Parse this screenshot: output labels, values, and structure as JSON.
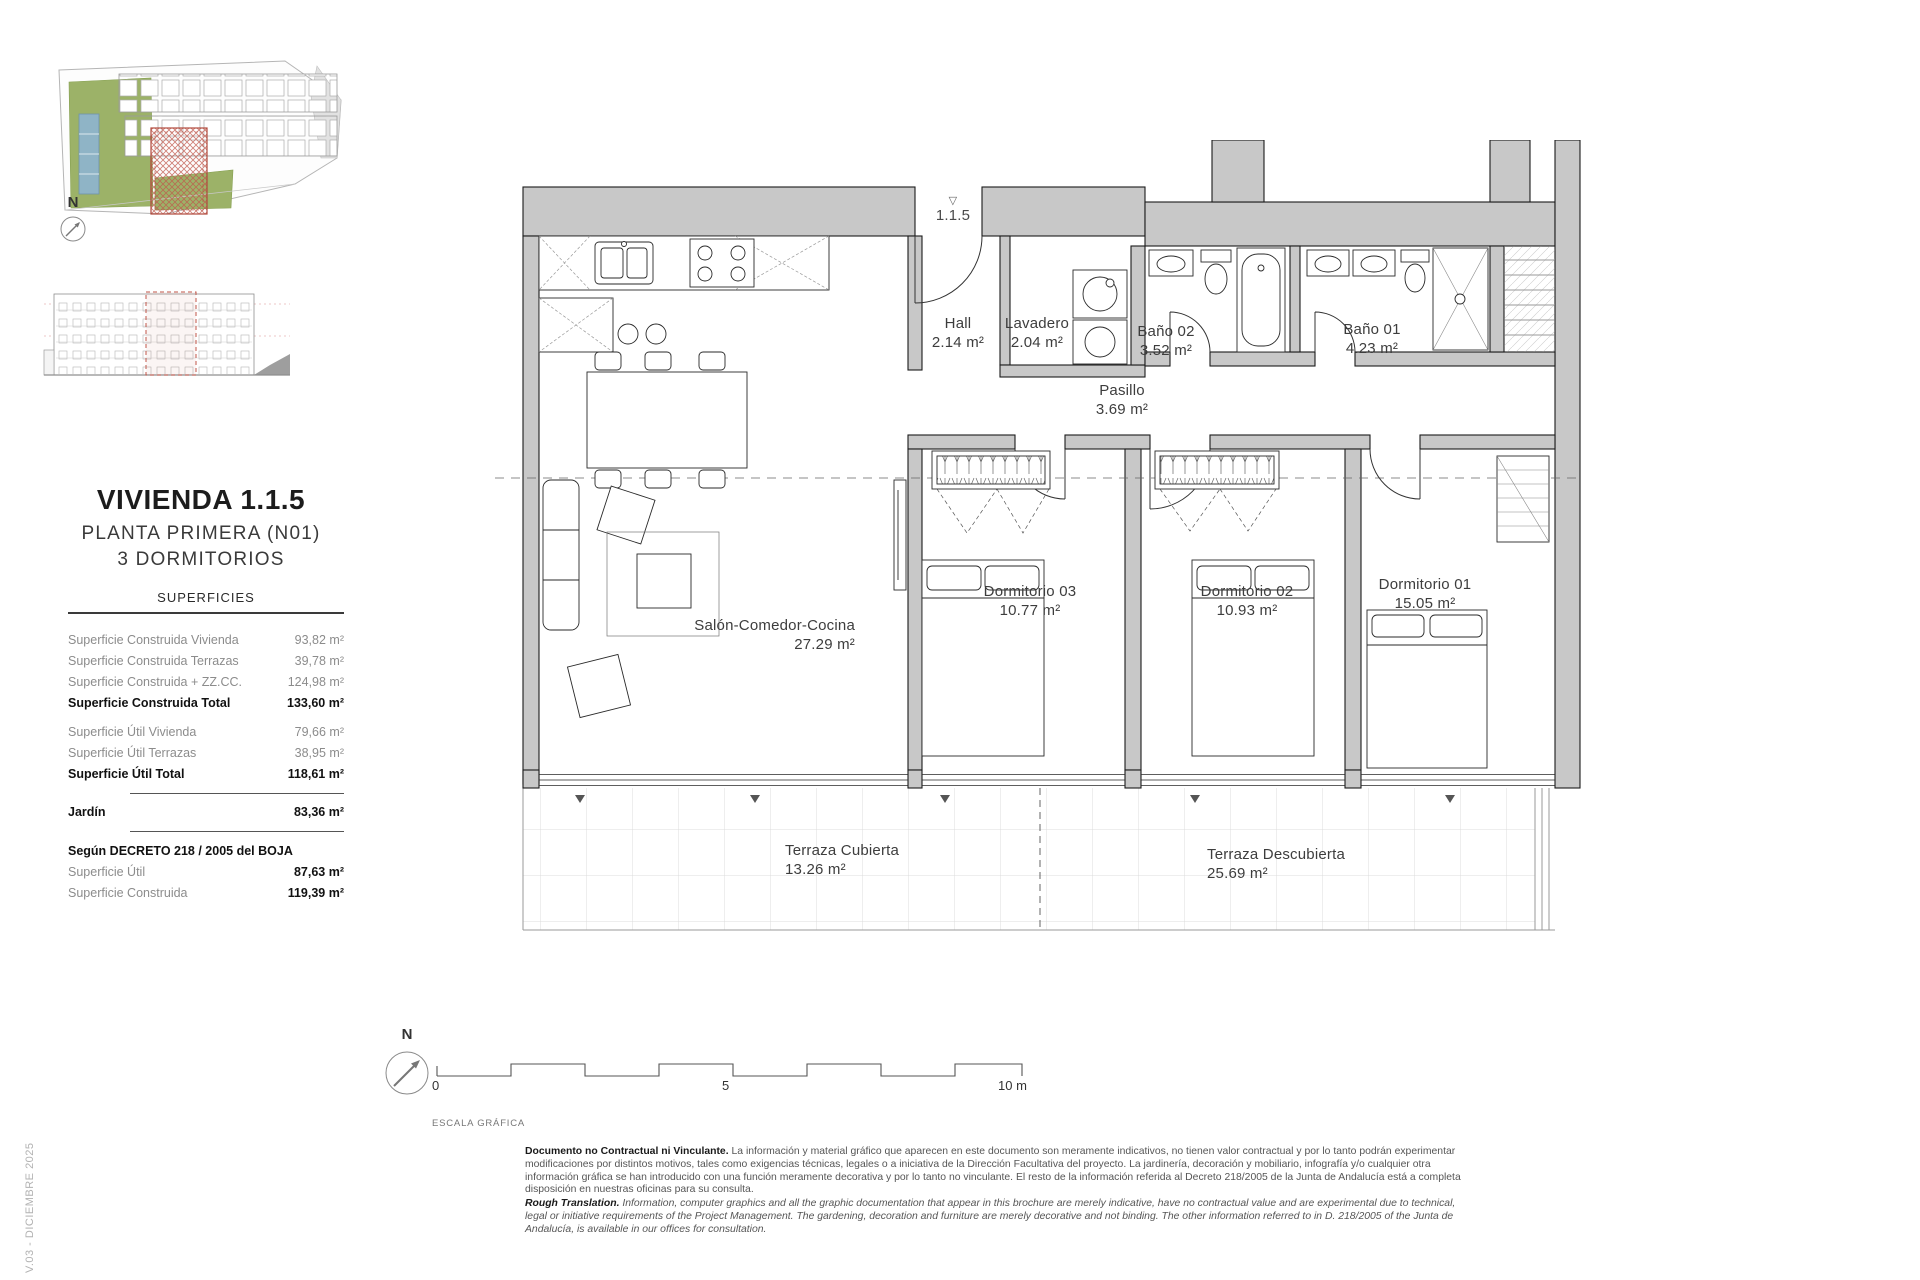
{
  "page": {
    "version": "V.03 - DICIEMBRE 2025"
  },
  "sidebar": {
    "title": "VIVIENDA 1.1.5",
    "subtitle_floor": "PLANTA PRIMERA (N01)",
    "subtitle_bedrooms": "3 DORMITORIOS",
    "surfaces": {
      "title": "SUPERFICIES",
      "rows": [
        {
          "label": "Superficie Construida Vivienda",
          "value": "93,82 m²"
        },
        {
          "label": "Superficie Construida Terrazas",
          "value": "39,78 m²"
        },
        {
          "label": "Superficie Construida + ZZ.CC.",
          "value": "124,98 m²"
        },
        {
          "label": "Superficie Construida Total",
          "value": "133,60 m²"
        },
        {
          "label": "Superficie Útil Vivienda",
          "value": "79,66 m²"
        },
        {
          "label": "Superficie Útil Terrazas",
          "value": "38,95 m²"
        },
        {
          "label": "Superficie Útil Total",
          "value": "118,61 m²"
        },
        {
          "label": "Jardín",
          "value": "83,36 m²"
        },
        {
          "label": "Según DECRETO 218 / 2005 del BOJA",
          "value": ""
        },
        {
          "label": "Superficie Útil",
          "value": "87,63 m²"
        },
        {
          "label": "Superficie Construida",
          "value": "119,39 m²"
        }
      ]
    }
  },
  "plan": {
    "unit_marker": "1.1.5",
    "unit_marker_icon": "▽",
    "rooms": {
      "hall": {
        "name": "Hall",
        "area": "2.14 m²"
      },
      "lavadero": {
        "name": "Lavadero",
        "area": "2.04 m²"
      },
      "bano02": {
        "name": "Baño 02",
        "area": "3.52 m²"
      },
      "bano01": {
        "name": "Baño 01",
        "area": "4.23 m²"
      },
      "pasillo": {
        "name": "Pasillo",
        "area": "3.69 m²"
      },
      "dorm03": {
        "name": "Dormitorio 03",
        "area": "10.77 m²"
      },
      "dorm02": {
        "name": "Dormitorio 02",
        "area": "10.93 m²"
      },
      "dorm01": {
        "name": "Dormitorio 01",
        "area": "15.05 m²"
      },
      "salon": {
        "name": "Salón-Comedor-Cocina",
        "area": "27.29 m²"
      },
      "terraza_cubierta": {
        "name": "Terraza Cubierta",
        "area": "13.26 m²"
      },
      "terraza_descubierta": {
        "name": "Terraza Descubierta",
        "area": "25.69 m²"
      }
    }
  },
  "scale_bar": {
    "tick_0": "0",
    "tick_5": "5",
    "tick_10": "10 m",
    "caption": "ESCALA GRÁFICA",
    "north_label": "N"
  },
  "footer": {
    "disclaimer_es_lead": "Documento no Contractual ni Vinculante.",
    "disclaimer_es_body": " La información y material gráfico que aparecen en este documento son meramente indicativos, no tienen valor contractual y por lo tanto podrán experimentar modificaciones por distintos motivos, tales como exigencias técnicas, legales o a iniciativa de la Dirección Facultativa del proyecto. La jardinería, decoración y mobiliario, infografía y/o cualquier otra información gráfica se han introducido con una función meramente decorativa y por lo tanto no vinculante. El resto de la información referida al Decreto 218/2005 de la Junta de Andalucía está a completa disposición en nuestras oficinas para su consulta.",
    "disclaimer_en_lead": "Rough Translation.",
    "disclaimer_en_body": " Information, computer graphics and all the graphic documentation that appear in this brochure are merely indicative, have no contractual value and are experimental due to technical, legal or initiative requirements of the Project Management. The gardening, decoration and furniture are merely decorative and not binding. The other information referred to in D. 218/2005 of the Junta de Andalucía, is available in our offices for consultation."
  },
  "colors": {
    "wall_gray": "#c8c8c8",
    "highlight_red": "#b0493c",
    "site_green": "#9cb268",
    "pool_blue": "#8fb4c6"
  }
}
